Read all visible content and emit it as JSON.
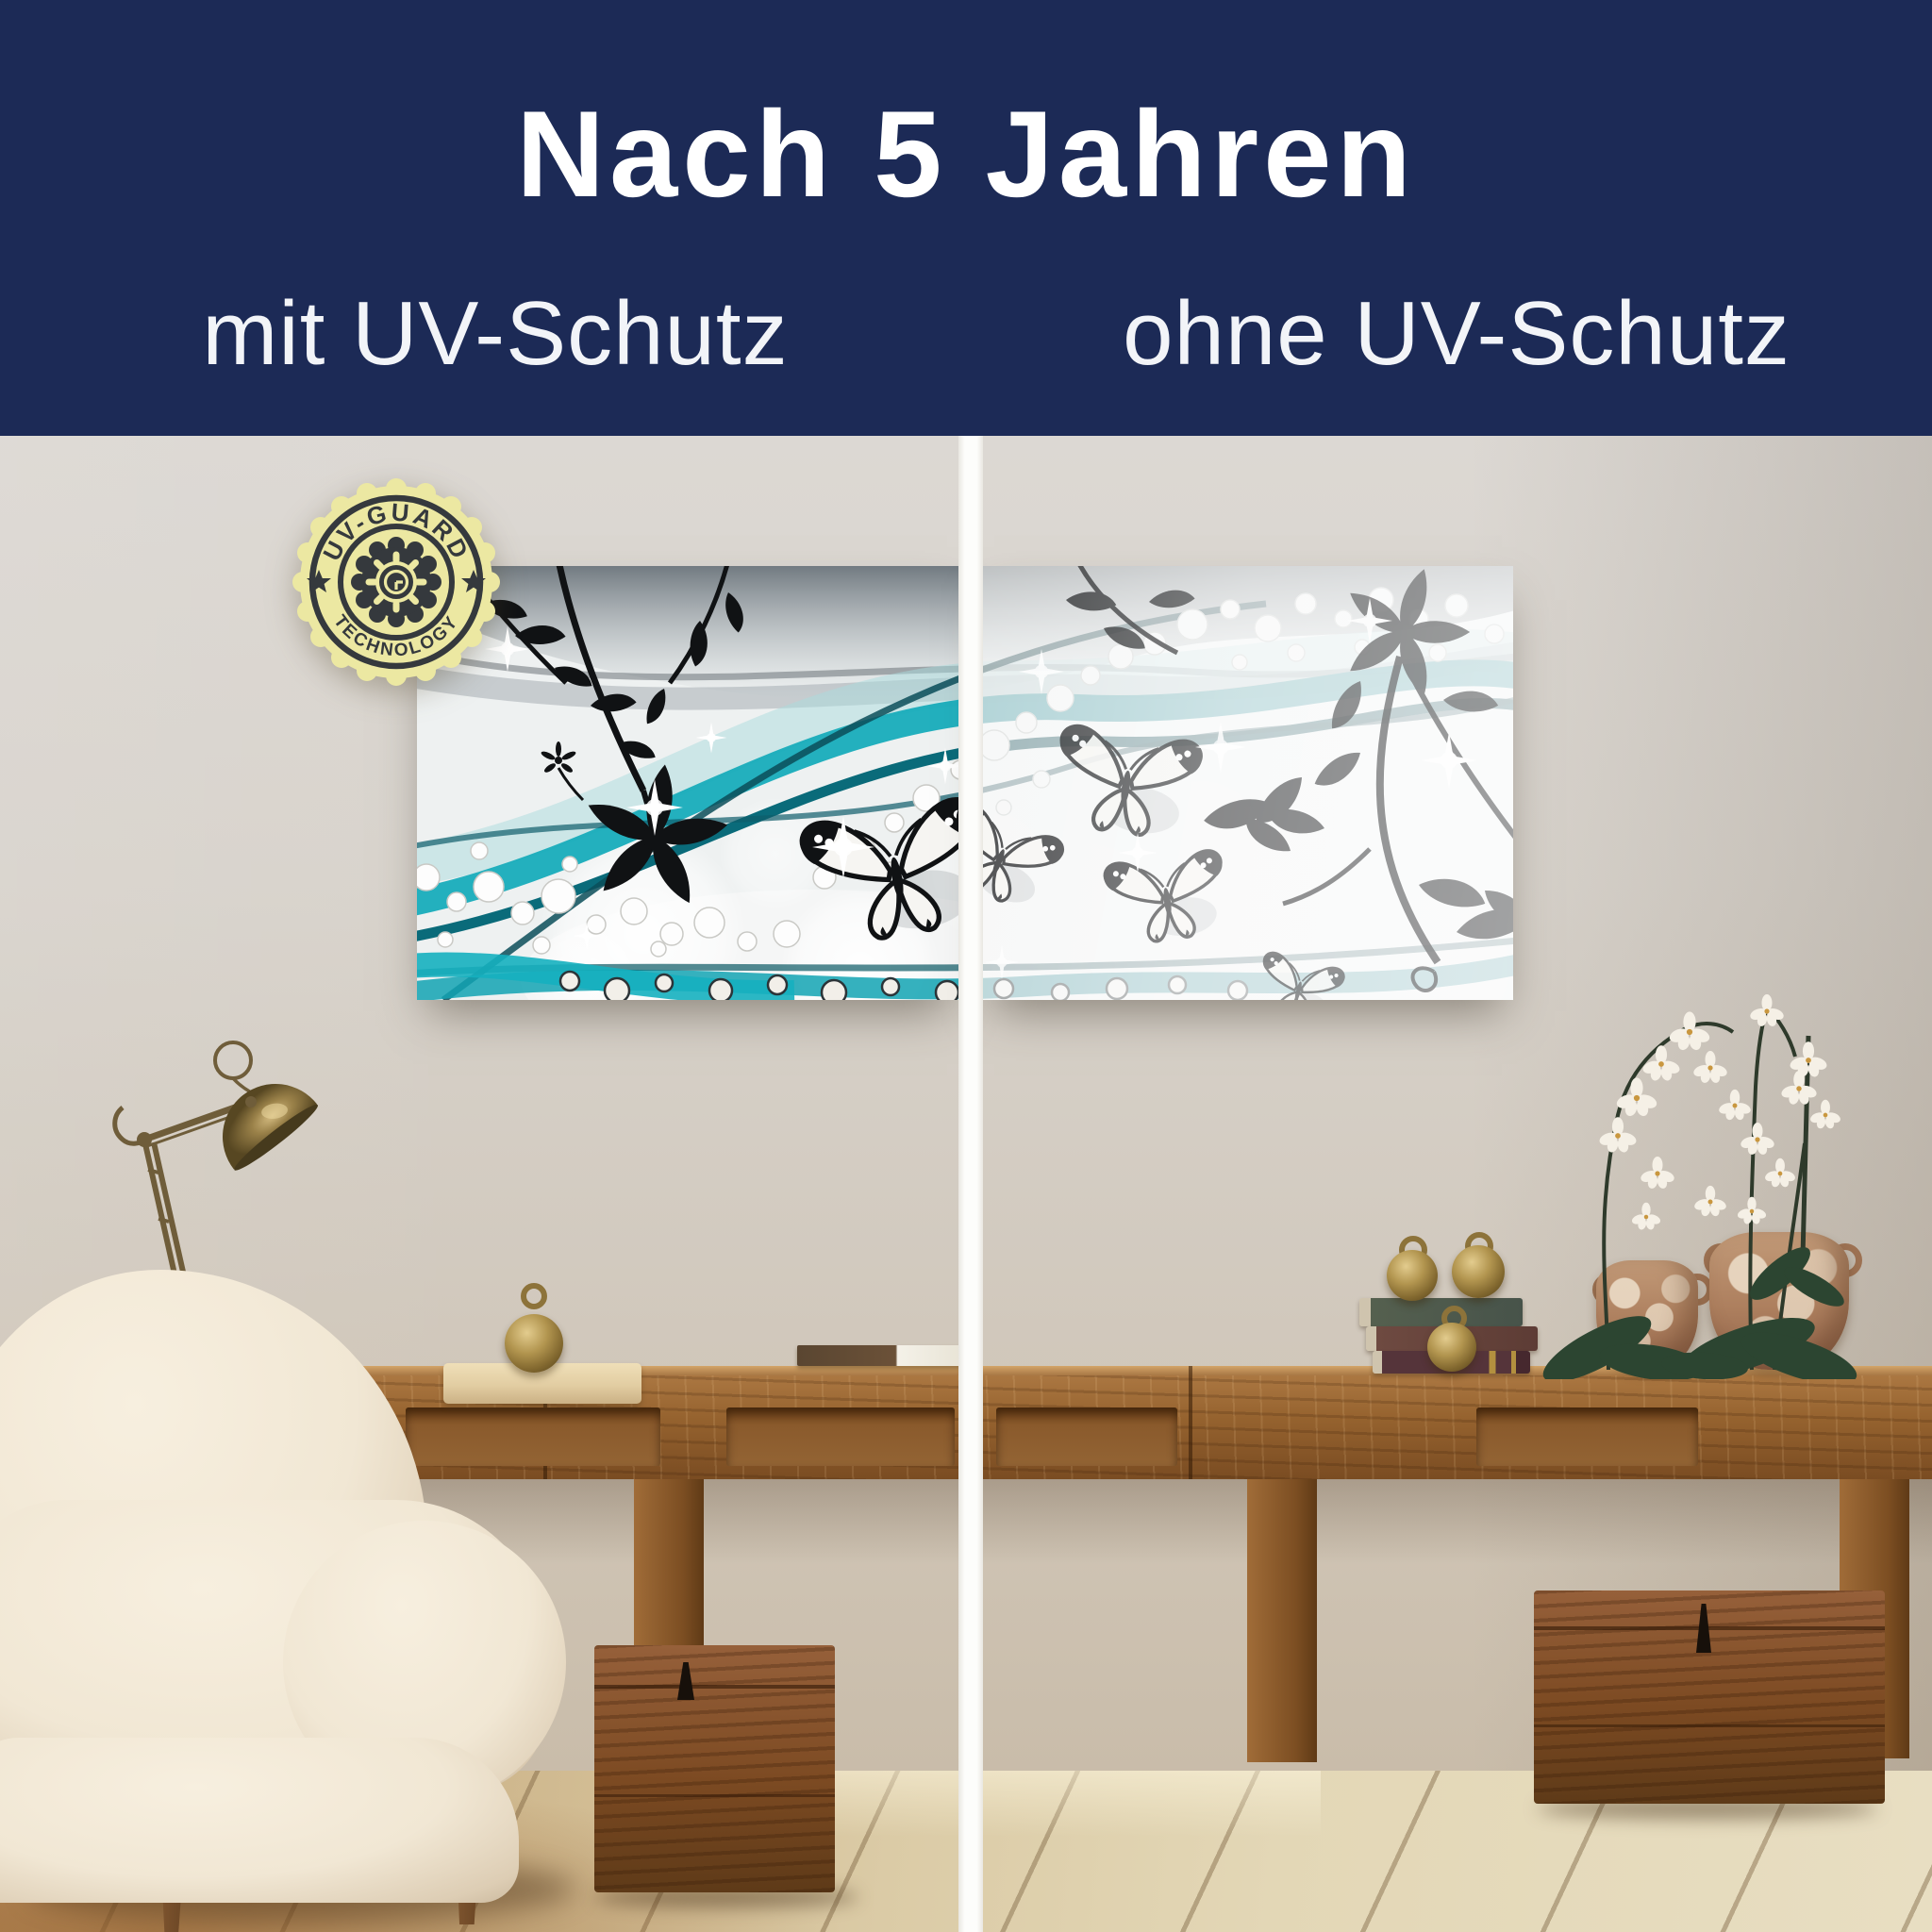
{
  "header": {
    "title": "Nach 5 Jahren",
    "label_left": "mit UV-Schutz",
    "label_right": "ohne UV-Schutz"
  },
  "badge": {
    "arc_top": "UV-GUARD",
    "arc_bottom": "TECHNOLOGY"
  },
  "comparison": {
    "left_side": "wall art protected with UV guard, colors still vivid",
    "right_side": "wall art without UV protection, colors faded"
  },
  "palette": {
    "header_navy": "#1c2a56",
    "text_white": "#ffffff",
    "divider_white": "#fdfdfb",
    "badge_yellow": "#ece8a2",
    "badge_ink": "#35393d",
    "artwork_teal": "#17acbb",
    "artwork_teal_deep": "#0a6b7a",
    "silhouette_black": "#101214",
    "wall_beige": "#d5cfc7",
    "wood_brown": "#8a5a2e",
    "floor_pale": "#ddd0ac",
    "brass": "#a08548",
    "chair_cream": "#f1e8d7",
    "terracotta": "#b5886a",
    "orchid_green": "#2c4531"
  },
  "scene_objects": [
    "abstract teal wave artwork with butterflies",
    "white vertical divider",
    "UV-Guard technology seal",
    "wooden console table",
    "two wooden chests",
    "white boucle armchair",
    "brass articulated desk lamp",
    "stack of vintage books",
    "brass bell ornaments",
    "two terracotta vases with white orchids",
    "wooden tray",
    "whitewashed plank floor"
  ]
}
